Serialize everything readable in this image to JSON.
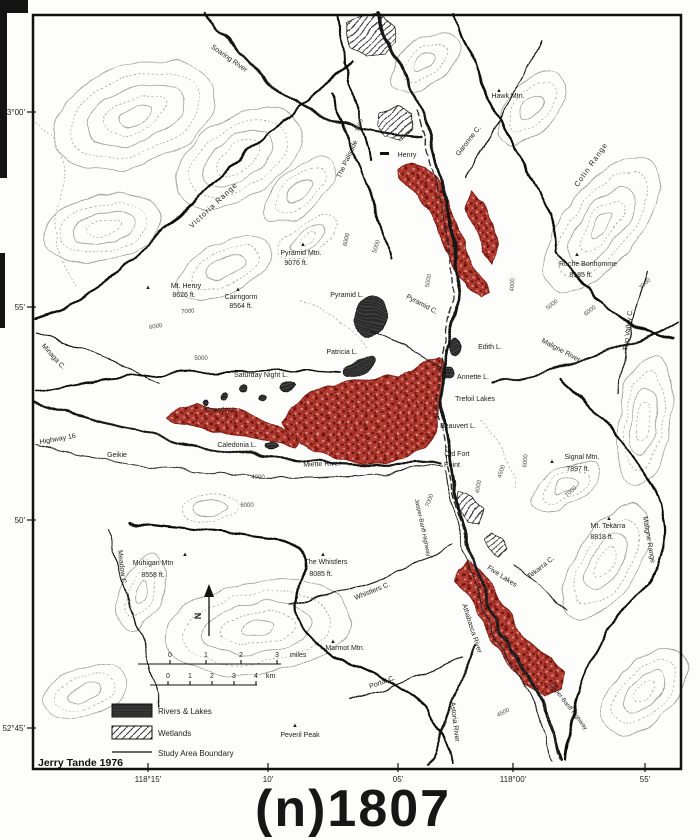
{
  "figure": {
    "title": "(n)1807",
    "attribution": "Jerry Tande 1976"
  },
  "axes": {
    "left": [
      {
        "label": "53°00'",
        "y": 112
      },
      {
        "label": "55'",
        "y": 307
      },
      {
        "label": "50'",
        "y": 520
      },
      {
        "label": "52°45'",
        "y": 728
      }
    ],
    "bottom": [
      {
        "label": "118°15'",
        "x": 148
      },
      {
        "label": "10'",
        "x": 268
      },
      {
        "label": "05'",
        "x": 398
      },
      {
        "label": "118°00'",
        "x": 513
      },
      {
        "label": "55'",
        "x": 645
      }
    ]
  },
  "legend": {
    "items": [
      {
        "label": "Rivers & Lakes",
        "swatch": "dark-hatch"
      },
      {
        "label": "Wetlands",
        "swatch": "diagonal-hatch"
      },
      {
        "label": "Study Area Boundary",
        "swatch": "line"
      }
    ]
  },
  "scale_bars": {
    "miles": {
      "unit": "miles",
      "unit_x": 290,
      "ticks": [
        {
          "t": "0",
          "x": 170
        },
        {
          "t": "1",
          "x": 206
        },
        {
          "t": "2",
          "x": 241
        },
        {
          "t": "3",
          "x": 277
        }
      ]
    },
    "km": {
      "unit": "km",
      "unit_x": 266,
      "ticks": [
        {
          "t": "0",
          "x": 168
        },
        {
          "t": "1",
          "x": 190
        },
        {
          "t": "2",
          "x": 212
        },
        {
          "t": "3",
          "x": 234
        },
        {
          "t": "4",
          "x": 256
        }
      ]
    }
  },
  "compass": {
    "label": "N"
  },
  "colors": {
    "burn": "#b23b30",
    "burn_dark": "#6f1410",
    "ink": "#1c1c1c",
    "contour": "#9d9d9d"
  },
  "peaks": [
    [
      499,
      89
    ],
    [
      148,
      286
    ],
    [
      238,
      288
    ],
    [
      303,
      243
    ],
    [
      577,
      253
    ],
    [
      552,
      460
    ],
    [
      609,
      517
    ],
    [
      323,
      553
    ],
    [
      333,
      640
    ],
    [
      185,
      553
    ],
    [
      295,
      724
    ]
  ],
  "map_labels": [
    {
      "text": "Soaring River",
      "x": 228,
      "y": 60,
      "rot": 35
    },
    {
      "text": "Hawk Mtn.",
      "x": 508,
      "y": 98,
      "rot": 0
    },
    {
      "text": "Garonne C.",
      "x": 470,
      "y": 142,
      "rot": -52
    },
    {
      "text": "Colin Range",
      "x": 593,
      "y": 166,
      "rot": -55,
      "size": 7.5,
      "sp": 1
    },
    {
      "text": "The Palisade",
      "x": 349,
      "y": 160,
      "rot": -65
    },
    {
      "text": "Henry",
      "x": 407,
      "y": 157,
      "rot": 0
    },
    {
      "text": "Victoria Range",
      "x": 215,
      "y": 207,
      "rot": -43,
      "size": 7.5,
      "sp": 1
    },
    {
      "text": "Mt. Henry",
      "x": 186,
      "y": 288,
      "rot": 0
    },
    {
      "text": "8626 ft.",
      "x": 184,
      "y": 297,
      "rot": 0
    },
    {
      "text": "Cairngorm",
      "x": 241,
      "y": 299,
      "rot": 0
    },
    {
      "text": "8564 ft.",
      "x": 241,
      "y": 308,
      "rot": 0
    },
    {
      "text": "Pyramid Mtn.",
      "x": 301,
      "y": 255,
      "rot": 0
    },
    {
      "text": "9076 ft.",
      "x": 296,
      "y": 265,
      "rot": 0
    },
    {
      "text": "Pyramid L.",
      "x": 347,
      "y": 297,
      "rot": 0
    },
    {
      "text": "Pyramid C.",
      "x": 421,
      "y": 306,
      "rot": 28
    },
    {
      "text": "Patricia L.",
      "x": 342,
      "y": 354,
      "rot": 0
    },
    {
      "text": "Saturday Night L.",
      "x": 261,
      "y": 377,
      "rot": 0
    },
    {
      "text": "Roche Bonhomme",
      "x": 588,
      "y": 266,
      "rot": 0
    },
    {
      "text": "8185 ft.",
      "x": 581,
      "y": 277,
      "rot": 0
    },
    {
      "text": "Two Valley C.",
      "x": 630,
      "y": 330,
      "rot": -83
    },
    {
      "text": "Maligne River",
      "x": 560,
      "y": 352,
      "rot": 28
    },
    {
      "text": "Minaga C.",
      "x": 52,
      "y": 358,
      "rot": 48
    },
    {
      "text": "Edith L.",
      "x": 490,
      "y": 349,
      "rot": 0
    },
    {
      "text": "Annette L.",
      "x": 473,
      "y": 379,
      "rot": 0
    },
    {
      "text": "Trefoil Lakes",
      "x": 475,
      "y": 401,
      "rot": 0
    },
    {
      "text": "Beauvert L.",
      "x": 458,
      "y": 428,
      "rot": 0
    },
    {
      "text": "Old Fort",
      "x": 457,
      "y": 456,
      "rot": 0
    },
    {
      "text": "Point",
      "x": 452,
      "y": 467,
      "rot": 0
    },
    {
      "text": "Highway 16",
      "x": 58,
      "y": 441,
      "rot": -10
    },
    {
      "text": "Geikie",
      "x": 117,
      "y": 457,
      "rot": 0
    },
    {
      "text": "Dorothy L.",
      "x": 222,
      "y": 412,
      "rot": 0
    },
    {
      "text": "Caledonia L.",
      "x": 237,
      "y": 447,
      "rot": 0
    },
    {
      "text": "Miette River",
      "x": 322,
      "y": 466,
      "rot": -2
    },
    {
      "text": "Signal Mtn.",
      "x": 582,
      "y": 459,
      "rot": 0
    },
    {
      "text": "7897 ft.",
      "x": 578,
      "y": 471,
      "rot": 0
    },
    {
      "text": "Mt. Tekarra",
      "x": 608,
      "y": 528,
      "rot": 0
    },
    {
      "text": "8818 ft.",
      "x": 602,
      "y": 539,
      "rot": 0
    },
    {
      "text": "Tekarra C.",
      "x": 542,
      "y": 569,
      "rot": -38
    },
    {
      "text": "Maligne Range",
      "x": 647,
      "y": 540,
      "rot": 80
    },
    {
      "text": "Meadow C.",
      "x": 120,
      "y": 568,
      "rot": 83
    },
    {
      "text": "Muhigan Mtn",
      "x": 153,
      "y": 565,
      "rot": 0
    },
    {
      "text": "8558 ft.",
      "x": 153,
      "y": 577,
      "rot": 0
    },
    {
      "text": "The Whistlers",
      "x": 326,
      "y": 564,
      "rot": 0
    },
    {
      "text": "8085 ft.",
      "x": 321,
      "y": 576,
      "rot": 0
    },
    {
      "text": "Whistlers C.",
      "x": 373,
      "y": 593,
      "rot": -22
    },
    {
      "text": "Marmot Mtn.",
      "x": 345,
      "y": 650,
      "rot": 0
    },
    {
      "text": "Portal C.",
      "x": 383,
      "y": 684,
      "rot": -20
    },
    {
      "text": "Peveril Peak",
      "x": 300,
      "y": 737,
      "rot": 0
    },
    {
      "text": "Five Lakes",
      "x": 501,
      "y": 578,
      "rot": 33
    },
    {
      "text": "Athabasca River",
      "x": 470,
      "y": 629,
      "rot": 72
    },
    {
      "text": "Astoria River",
      "x": 453,
      "y": 722,
      "rot": 83
    },
    {
      "text": "Jasper-Banff Highway",
      "x": 421,
      "y": 528,
      "rot": 78,
      "size": 6
    },
    {
      "text": "Jasper-Banff Highway",
      "x": 567,
      "y": 707,
      "rot": 52,
      "size": 6
    },
    {
      "text": "7500",
      "x": 361,
      "y": 126,
      "rot": -72,
      "cls": "ct",
      "size": 6
    },
    {
      "text": "7000",
      "x": 188,
      "y": 313,
      "rot": -5,
      "cls": "ct",
      "size": 6
    },
    {
      "text": "6000",
      "x": 156,
      "y": 328,
      "rot": -8,
      "cls": "ct",
      "size": 6
    },
    {
      "text": "5000",
      "x": 201,
      "y": 360,
      "rot": 0,
      "cls": "ct",
      "size": 6
    },
    {
      "text": "6000",
      "x": 348,
      "y": 240,
      "rot": -78,
      "cls": "ct",
      "size": 6
    },
    {
      "text": "5000",
      "x": 378,
      "y": 247,
      "rot": -72,
      "cls": "ct",
      "size": 6
    },
    {
      "text": "5000",
      "x": 430,
      "y": 281,
      "rot": -80,
      "cls": "ct",
      "size": 6
    },
    {
      "text": "4000",
      "x": 514,
      "y": 285,
      "rot": -85,
      "cls": "ct",
      "size": 6
    },
    {
      "text": "5000",
      "x": 553,
      "y": 306,
      "rot": -38,
      "cls": "ct",
      "size": 6
    },
    {
      "text": "6000",
      "x": 591,
      "y": 312,
      "rot": -38,
      "cls": "ct",
      "size": 6
    },
    {
      "text": "7000",
      "x": 646,
      "y": 285,
      "rot": -45,
      "cls": "ct",
      "size": 6
    },
    {
      "text": "6000",
      "x": 527,
      "y": 461,
      "rot": -85,
      "cls": "ct",
      "size": 6
    },
    {
      "text": "7000",
      "x": 572,
      "y": 493,
      "rot": -42,
      "cls": "ct",
      "size": 6
    },
    {
      "text": "7000",
      "x": 431,
      "y": 501,
      "rot": -70,
      "cls": "ct",
      "size": 6
    },
    {
      "text": "4000",
      "x": 480,
      "y": 487,
      "rot": -80,
      "cls": "ct",
      "size": 6
    },
    {
      "text": "4500",
      "x": 503,
      "y": 472,
      "rot": -72,
      "cls": "ct",
      "size": 6
    },
    {
      "text": "4500",
      "x": 504,
      "y": 714,
      "rot": -28,
      "cls": "ct",
      "size": 6
    },
    {
      "text": "4000",
      "x": 258,
      "y": 479,
      "rot": 0,
      "cls": "ct",
      "size": 6
    },
    {
      "text": "6000",
      "x": 247,
      "y": 507,
      "rot": 0,
      "cls": "ct",
      "size": 6
    }
  ]
}
